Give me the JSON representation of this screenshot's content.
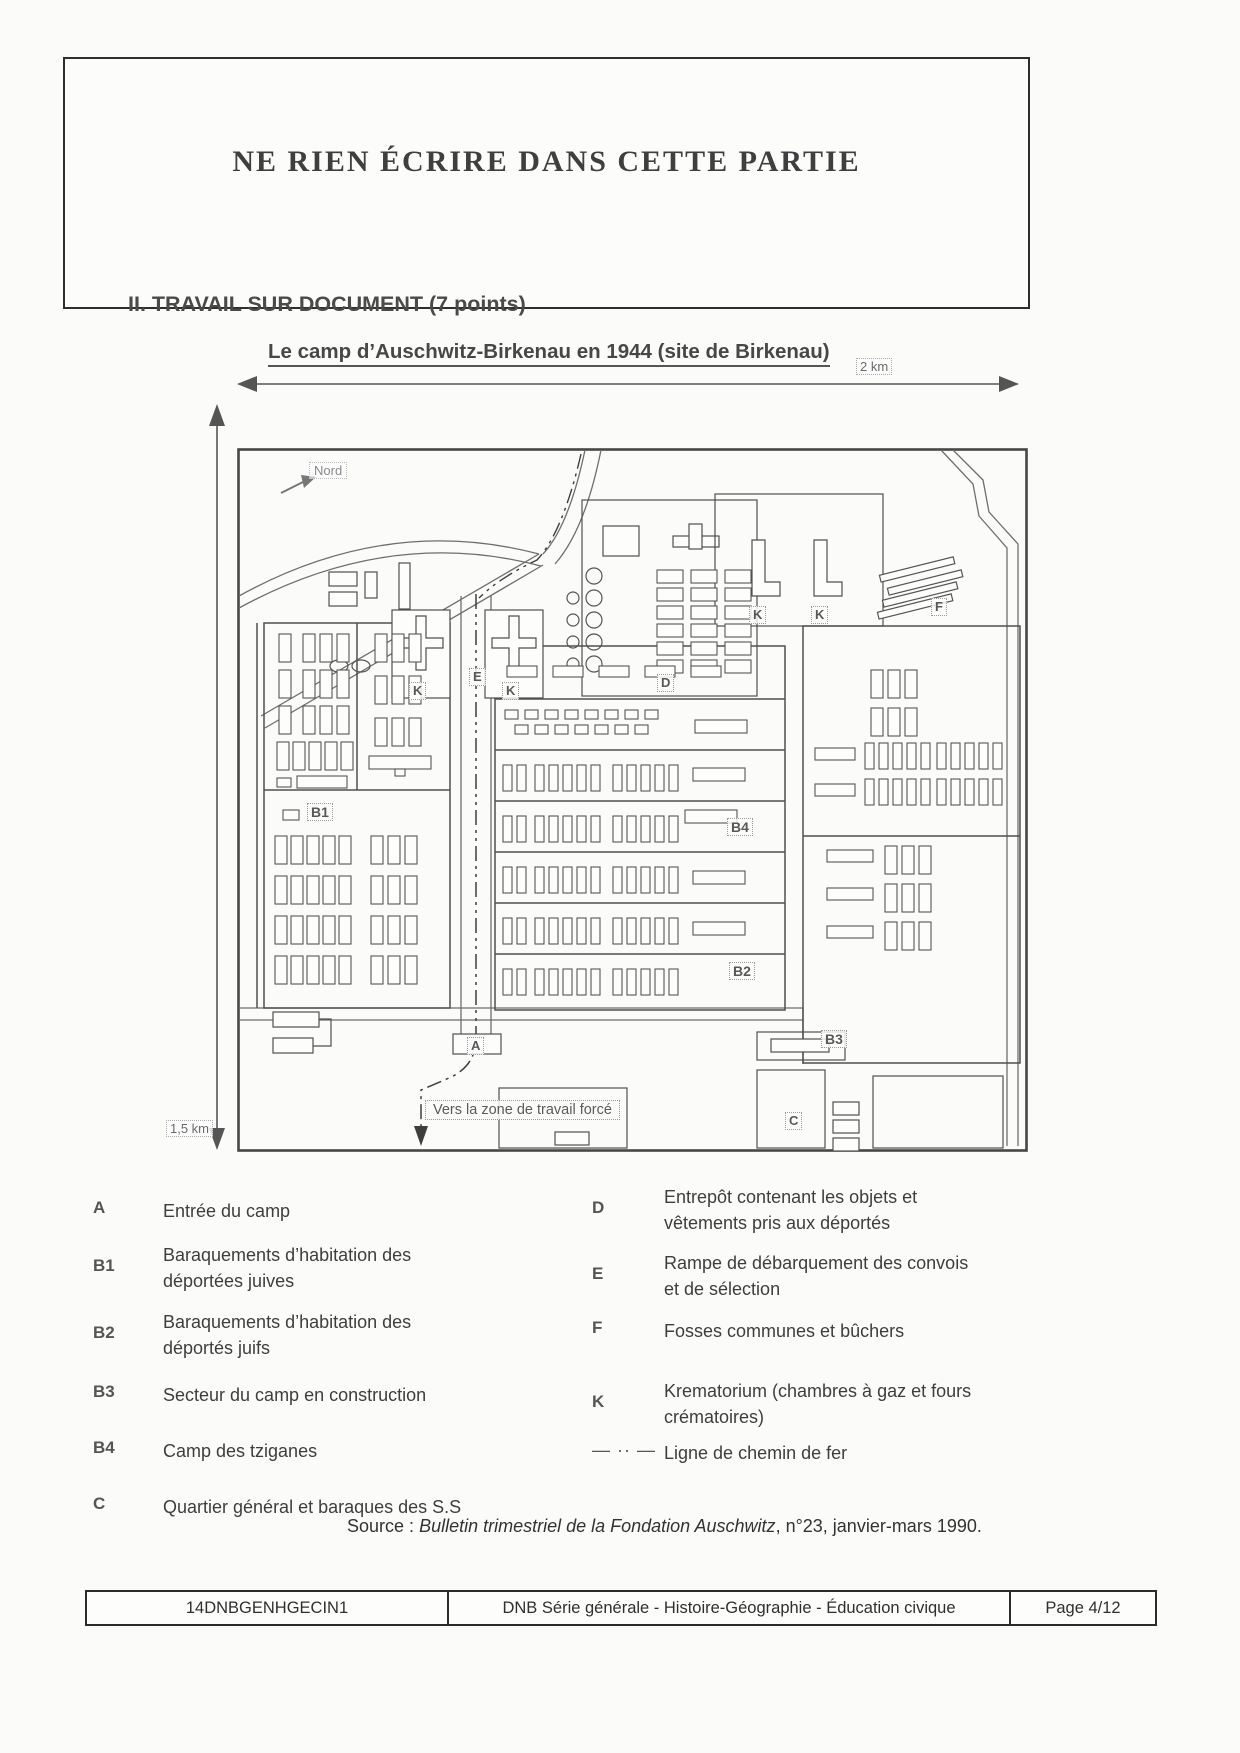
{
  "page": {
    "do_not_write": "NE RIEN ÉCRIRE DANS CETTE PARTIE",
    "section_heading": "II. TRAVAIL SUR DOCUMENT (7 points)",
    "map_title": "Le camp d’Auschwitz-Birkenau en 1944 (site de Birkenau)"
  },
  "map": {
    "scale_top": "2 km",
    "scale_left": "1,5 km",
    "north_label": "Nord",
    "exit_label": "Vers la zone de travail forcé",
    "labels": {
      "A": "A",
      "B1": "B1",
      "B2": "B2",
      "B3": "B3",
      "B4": "B4",
      "C": "C",
      "D": "D",
      "E": "E",
      "F": "F",
      "K": "K"
    }
  },
  "legend": {
    "left": [
      {
        "key": "A",
        "text": "Entrée du camp"
      },
      {
        "key": "B1",
        "text": "Baraquements d’habitation des\ndéportées juives"
      },
      {
        "key": "B2",
        "text": "Baraquements d’habitation des\ndéportés juifs"
      },
      {
        "key": "B3",
        "text": "Secteur du camp en construction"
      },
      {
        "key": "B4",
        "text": "Camp des tziganes"
      },
      {
        "key": "C",
        "text": "Quartier général et baraques des S.S"
      }
    ],
    "right": [
      {
        "key": "D",
        "text": "Entrepôt contenant les objets et\nvêtements pris aux déportés"
      },
      {
        "key": "E",
        "text": "Rampe de débarquement des convois\net de sélection"
      },
      {
        "key": "F",
        "text": "Fosses communes et bûchers"
      },
      {
        "key": "K",
        "text": "Krematorium (chambres à gaz et fours\ncrématoires)"
      }
    ],
    "rail_symbol": "— ·· —",
    "rail_text": "Ligne de chemin de fer"
  },
  "source": {
    "label": "Source :",
    "title": "Bulletin trimestriel de la Fondation Auschwitz",
    "suffix": ", n°23, janvier-mars 1990."
  },
  "footer": {
    "code": "14DNBGENHGECIN1",
    "center": "DNB Série générale - Histoire-Géographie - Éducation civique",
    "page": "Page 4/12"
  }
}
